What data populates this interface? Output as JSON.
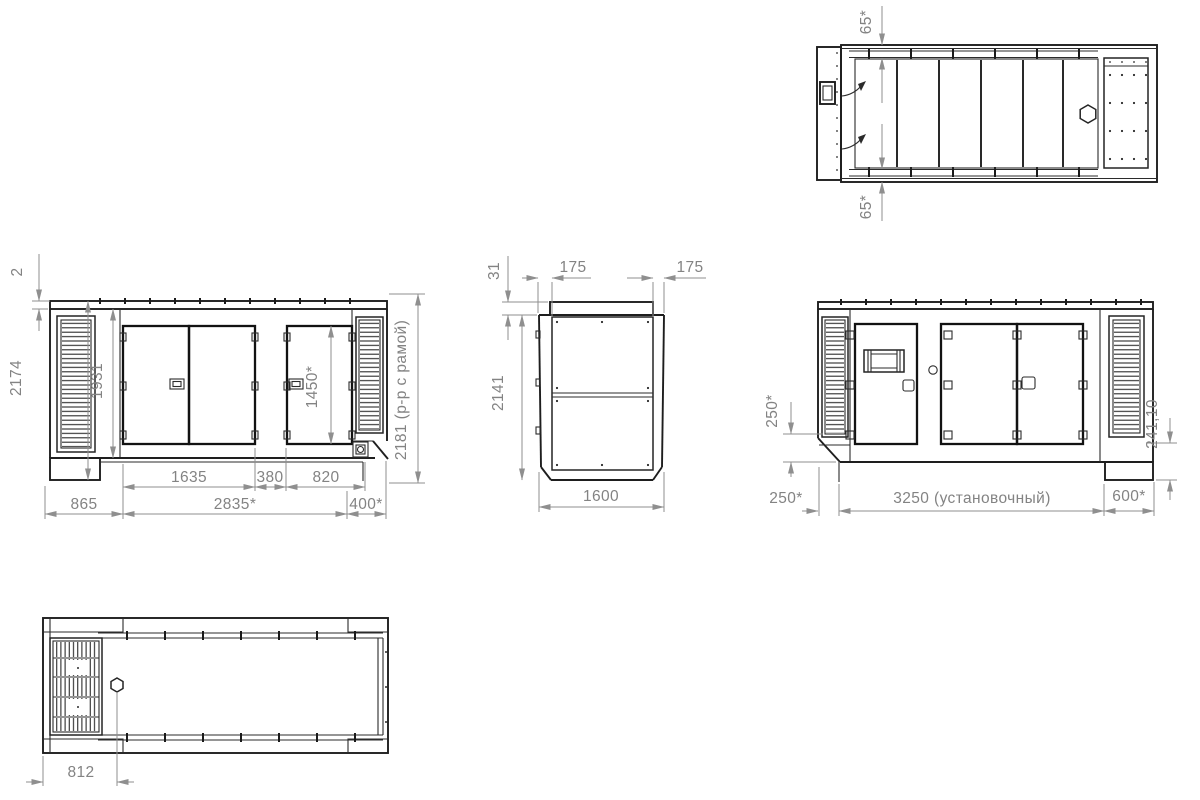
{
  "drawing_type": "technical-multiview-drawing",
  "colors": {
    "line": "#262626",
    "dimension": "#8a8a8a",
    "background": "#ffffff"
  },
  "views": {
    "top": {
      "name": "top view",
      "dims": {
        "roof_edge_top": "65*",
        "roof_edge_bottom": "65*"
      }
    },
    "front": {
      "name": "front view",
      "dims": {
        "roof_lip": "2",
        "overall_height": "2174",
        "body_height": "1931",
        "door_height": "1450*",
        "double_door_width": "1635",
        "mid_panel_width": "380",
        "right_door_width": "820",
        "left_module_length": "865",
        "body_length": "2835*",
        "right_module_length": "400*",
        "frame_height": "2181 (р-р с рамой)"
      }
    },
    "end": {
      "name": "end view",
      "dims": {
        "roof_cap_height": "31",
        "side_offset_left": "175",
        "side_offset_right": "175",
        "height": "2141",
        "width": "1600"
      }
    },
    "rear": {
      "name": "rear view",
      "dims": {
        "corner_cut_height": "250*",
        "base_corner": "241,10",
        "left_offset": "250*",
        "mounting_length": "3250 (установочный)",
        "right_offset": "600*"
      }
    },
    "bottom": {
      "name": "bottom view",
      "dims": {
        "drain_offset": "812"
      }
    }
  }
}
